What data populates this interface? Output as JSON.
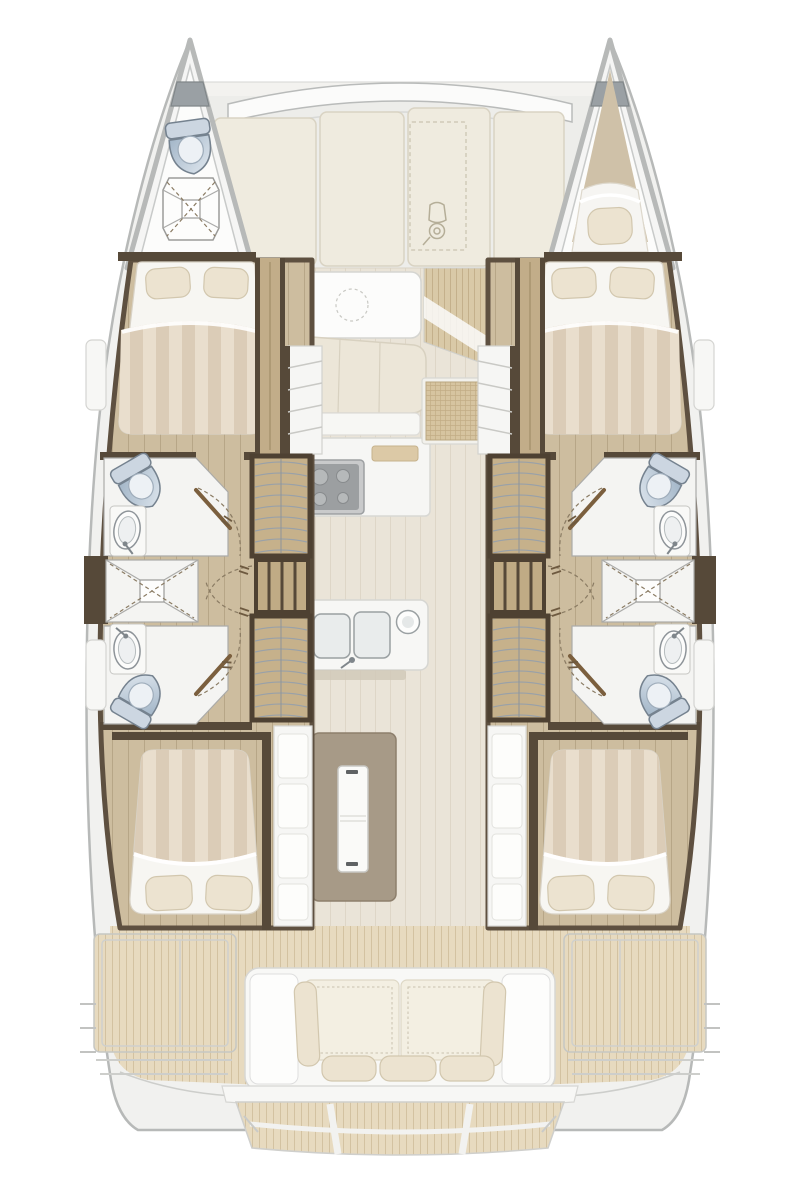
{
  "meta": {
    "title": "catamaran-accommodation-floor-plan",
    "view": "overhead top-down deck plan, no text labels rendered"
  },
  "palette": {
    "page_bg": "#ffffff",
    "hull_outline": "#b7b9b8",
    "hull_fill": "#f1f1ef",
    "deck_gray": "#ededea",
    "panel_cream": "#efebdf",
    "panel_edge": "#d9d3c3",
    "salon_floor": "#eae4d8",
    "salon_floor_line": "#ded6c7",
    "plank": "#cdbd9f",
    "plank_line": "#b7a687",
    "wall_wood": "#564939",
    "door_wood": "#7b5f3e",
    "wardrobe_frame": "#4e4132",
    "wardrobe_fill": "#c6b18b",
    "shelf_line": "#9aa1a7",
    "white_room": "#f4f4f2",
    "fixture_stroke": "#75828f",
    "toilet_light": "#e2e9f0",
    "toilet_dark": "#a3b6c8",
    "bed_stripe_a": "#dbccb7",
    "bed_stripe_b": "#e9decd",
    "sheet_white": "#f7f6f2",
    "pillow": "#ece3d0",
    "pillow_edge": "#d2c7ae",
    "table_white": "#fcfcfb",
    "settee": "#ece6d8",
    "island": "#a79a87",
    "stove_dark": "#9c9fa1",
    "stove_light": "#c9cacb",
    "teak_aft": "#e7dabf",
    "teak_aft_line": "#d3c2a1",
    "teak_mid": "#d9c9a7",
    "teak_mid_line": "#c4b08b",
    "grid_mat": "#d6c4a0",
    "grid_line": "#c2ad85",
    "cockpit_white": "#f8f8f6",
    "cockpit_edge": "#d7d7d4",
    "cushion": "#f3efe2",
    "stitch": "#c9c2ae",
    "arc_dash": "#8a7b63",
    "anchor_locker": "#9aa0a4"
  },
  "vessel": {
    "type": "catamaran",
    "symmetry": "starboard hull mirrors port hull",
    "hulls": [
      {
        "id": "port",
        "bow": [
          "anchor-locker",
          "marine-toilet",
          "shower-pan"
        ],
        "forward_cabin": [
          "double-berth",
          "two-pillows",
          "striped-duvet",
          "hanging-locker-column"
        ],
        "midship": [
          "forward-head: toilet + washbasin",
          "central-shower-pan",
          "aft-head: toilet + washbasin",
          "two-curved-shelf-wardrobes",
          "divided-locker",
          "door-swing-arcs"
        ],
        "aft_cabin": [
          "double-berth",
          "two-pillows",
          "striped-duvet",
          "storage-steps-column"
        ]
      },
      {
        "id": "starboard",
        "bow": [
          "anchor-locker",
          "single-berth",
          "one-pillow"
        ],
        "forward_cabin": [
          "double-berth",
          "two-pillows",
          "striped-duvet",
          "hanging-locker-column"
        ],
        "midship": [
          "forward-head: toilet + washbasin",
          "central-shower-pan",
          "aft-head: toilet + washbasin",
          "two-curved-shelf-wardrobes",
          "divided-locker",
          "door-swing-arcs"
        ],
        "aft_cabin": [
          "double-berth",
          "two-pillows",
          "striped-duvet",
          "storage-steps-column"
        ]
      }
    ],
    "bridgedeck": {
      "foredeck": [
        "curved-crossbeam-band",
        "four-sunpad-panels",
        "dinghy-stowage-dashed-outline",
        "outboard-dinghy-icon"
      ],
      "salon": [
        "dining-table",
        "dashed-circle-hatch",
        "curved-settee",
        "galley-counter",
        "four-burner-stove",
        "double-sink",
        "round-sink",
        "galley-island-with-fridge",
        "entry-grid-mat",
        "teak-entry-slope",
        "two-companionway-stairs"
      ],
      "cockpit": [
        "curved-salon-aft-wall",
        "teak-sole",
        "two-framed-side-deck-panels",
        "aft-bench: 2 back cushions + 2 bolsters + 3 seat pillows",
        "transom-beam",
        "teak-swim-platform",
        "side-boarding-steps"
      ]
    },
    "fixture_counts": {
      "double_berths": 4,
      "bow_berths": 1,
      "toilets": 5,
      "washbasins": 4,
      "shower_pans": 3,
      "wardrobes": 4,
      "stair_flights": 2
    }
  }
}
